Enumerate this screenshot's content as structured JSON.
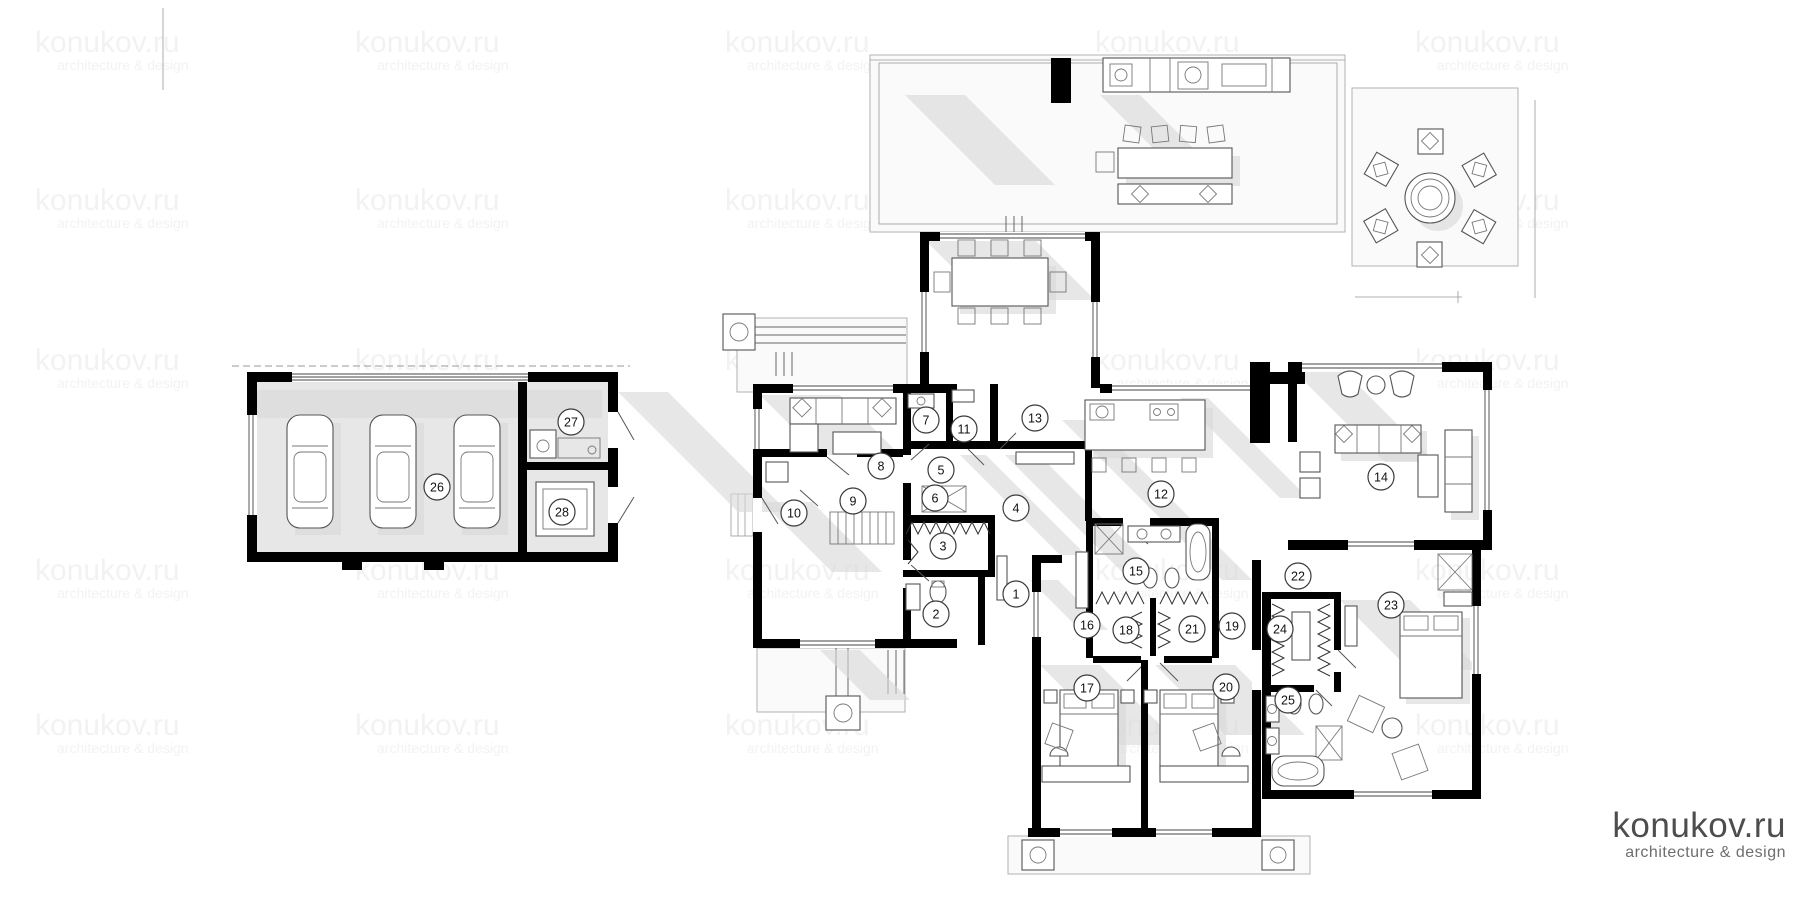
{
  "watermark": {
    "line1": "konukov.ru",
    "line2": "architecture & design",
    "color": "#ededed",
    "opacity": 0.7,
    "columns": [
      35,
      355,
      725,
      1095,
      1415
    ],
    "rows": [
      52,
      210,
      370,
      580,
      735
    ]
  },
  "logo": {
    "line1": "konukov.ru",
    "line2": "architecture & design",
    "color1": "#4d4d4d",
    "color2": "#6e6e6e"
  },
  "rooms": [
    {
      "number": "1",
      "x": 1016,
      "y": 594
    },
    {
      "number": "2",
      "x": 936,
      "y": 614
    },
    {
      "number": "3",
      "x": 943,
      "y": 546
    },
    {
      "number": "4",
      "x": 1016,
      "y": 508
    },
    {
      "number": "5",
      "x": 941,
      "y": 470
    },
    {
      "number": "6",
      "x": 935,
      "y": 498
    },
    {
      "number": "7",
      "x": 926,
      "y": 420
    },
    {
      "number": "8",
      "x": 881,
      "y": 466
    },
    {
      "number": "9",
      "x": 853,
      "y": 501
    },
    {
      "number": "10",
      "x": 794,
      "y": 513
    },
    {
      "number": "11",
      "x": 964,
      "y": 429
    },
    {
      "number": "12",
      "x": 1161,
      "y": 494
    },
    {
      "number": "13",
      "x": 1035,
      "y": 418
    },
    {
      "number": "14",
      "x": 1381,
      "y": 477
    },
    {
      "number": "15",
      "x": 1136,
      "y": 571
    },
    {
      "number": "16",
      "x": 1087,
      "y": 625
    },
    {
      "number": "17",
      "x": 1087,
      "y": 688
    },
    {
      "number": "18",
      "x": 1126,
      "y": 630
    },
    {
      "number": "19",
      "x": 1232,
      "y": 626
    },
    {
      "number": "20",
      "x": 1226,
      "y": 687
    },
    {
      "number": "21",
      "x": 1192,
      "y": 629
    },
    {
      "number": "22",
      "x": 1298,
      "y": 576
    },
    {
      "number": "23",
      "x": 1391,
      "y": 605
    },
    {
      "number": "24",
      "x": 1280,
      "y": 629
    },
    {
      "number": "25",
      "x": 1288,
      "y": 700
    },
    {
      "number": "26",
      "x": 437,
      "y": 487
    },
    {
      "number": "27",
      "x": 571,
      "y": 422
    },
    {
      "number": "28",
      "x": 562,
      "y": 512
    }
  ],
  "colors": {
    "wall": "#000000",
    "shadow": "#d9d9d9",
    "floor": "#e7e7e7",
    "badge_stroke": "#3a3a3a"
  }
}
